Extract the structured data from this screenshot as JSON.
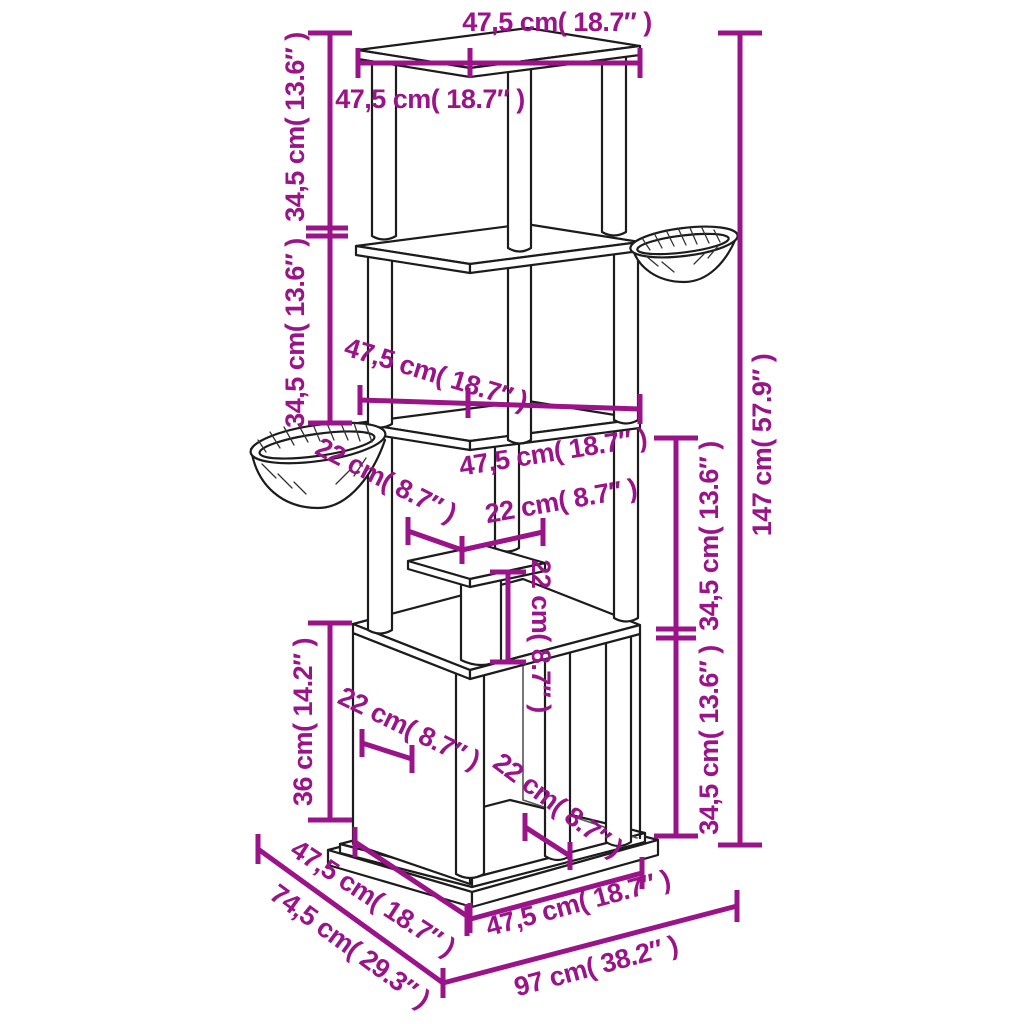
{
  "colors": {
    "dimension": "#9a1388",
    "line_art": "#1c1c1c",
    "background": "#ffffff"
  },
  "labels": {
    "top_back_width": "47,5 cm( 18.7″ )",
    "top_front_width": "47,5 cm( 18.7″ )",
    "left_upper_height": "34,5 cm( 13.6″ )",
    "left_mid_height": "34,5 cm( 13.6″ )",
    "total_height": "147 cm( 57.9″ )",
    "right_upper_height": "34,5 cm( 13.6″ )",
    "right_lower_height": "34,5 cm( 13.6″ )",
    "mid_left_width": "47,5 cm( 18.7″ )",
    "mid_right_width": "47,5 cm( 18.7″ )",
    "bowl_diameter": "22 cm( 8.7″ )",
    "step_width": "22 cm( 8.7″ )",
    "step_height": "22 cm( 8.7″ )",
    "lower_left_height": "36 cm( 14.2″ )",
    "box_left_width": "22 cm( 8.7″ )",
    "box_right_width": "22 cm( 8.7″ )",
    "base_left_edge": "47,5 cm( 18.7″ )",
    "base_total_depth": "74,5 cm( 29.3″ )",
    "base_right_edge": "47,5 cm( 18.7″ )",
    "base_total_width": "97 cm( 38.2″ )"
  }
}
